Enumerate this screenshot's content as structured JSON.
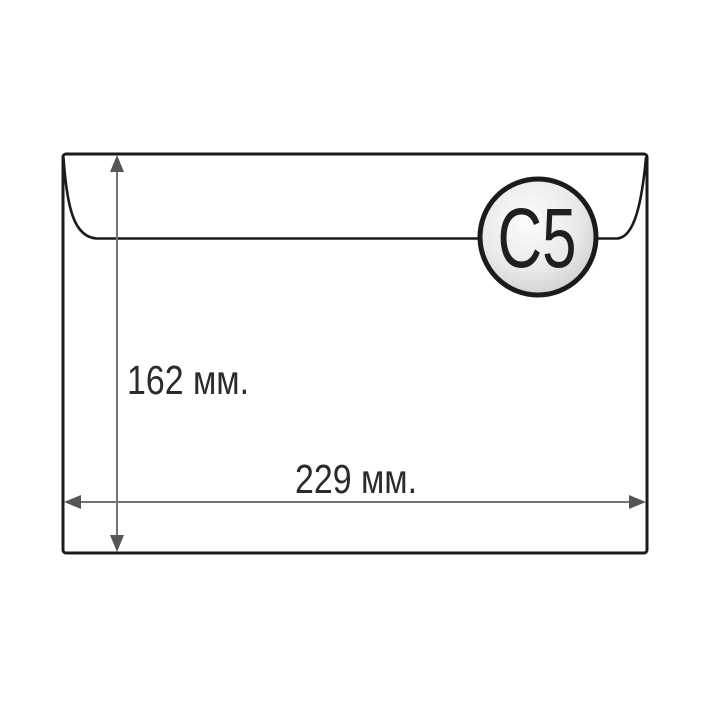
{
  "diagram": {
    "title": "envelope-size-diagram",
    "badge_label": "C5",
    "height_label": "162 мм.",
    "width_label": "229 мм."
  },
  "colors": {
    "background": "#ffffff",
    "envelope_fill": "#ffffff",
    "outline_ink": "#1b1b1b",
    "dimension_line": "#737373",
    "dimension_arrowhead": "#565656",
    "label_text": "#2b2b2b",
    "badge_gradient_center": "#fdfdfd",
    "badge_gradient_mid": "#e9e9e9",
    "badge_gradient_edge": "#c5c5c5",
    "badge_text": "#1f1f1f"
  },
  "icons": {
    "badge": "c5-size-badge",
    "height_arrow": "vertical-double-arrow",
    "width_arrow": "horizontal-double-arrow"
  }
}
